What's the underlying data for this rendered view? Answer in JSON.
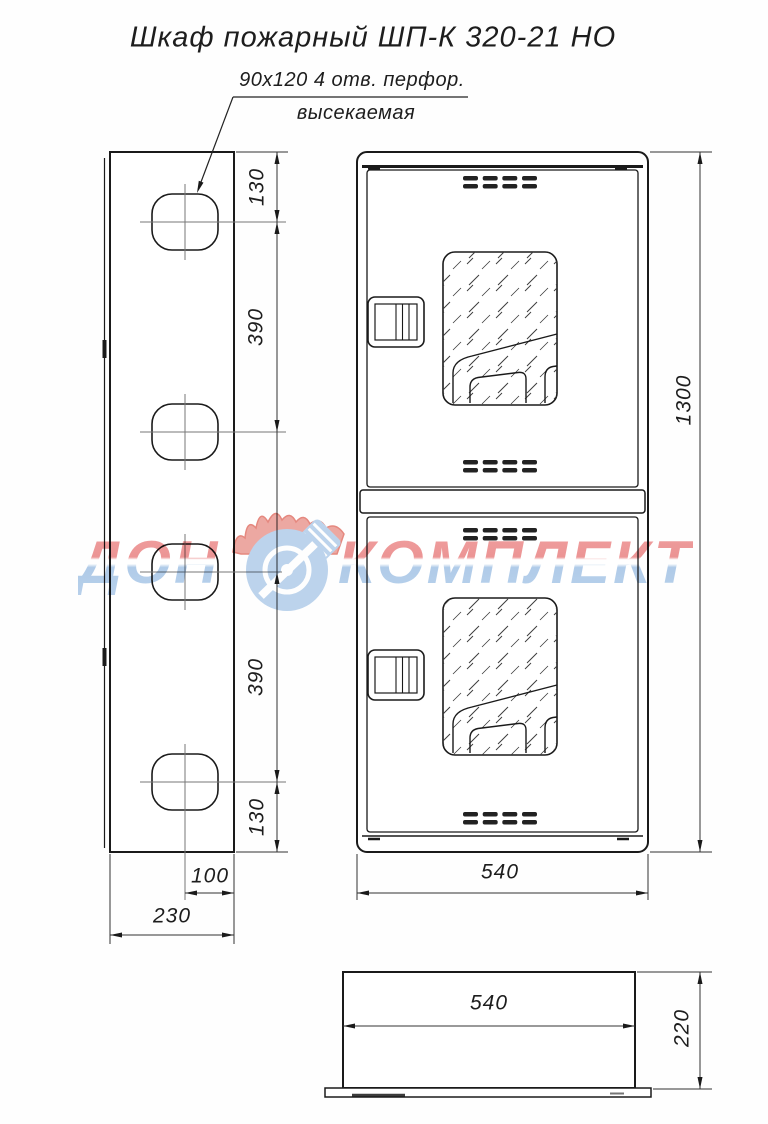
{
  "title": "Шкаф пожарный ШП-К 320-21 НО",
  "perforation_note": {
    "line1": "90x120  4 отв. перфор.",
    "line2": "высекаемая"
  },
  "side_view": {
    "dim_top_to_hole1": "130",
    "dim_hole1_to_hole2": "390",
    "dim_hole3_to_hole4": "390",
    "dim_hole4_to_bottom": "130",
    "dim_hole_center_to_edge": "100",
    "dim_depth": "230"
  },
  "front_view": {
    "dim_height": "1300",
    "dim_width": "540"
  },
  "top_view": {
    "dim_width": "540",
    "dim_depth": "220"
  },
  "watermark": {
    "word_left": "ДОН",
    "word_right": "КОМПЛЕКТ",
    "flame_color": "#e78a82",
    "flame_edge_color": "#dd5f52",
    "circle_color": "#aecbe9",
    "text_red": "#ec8c8c",
    "text_blue": "#a9c7e8"
  }
}
